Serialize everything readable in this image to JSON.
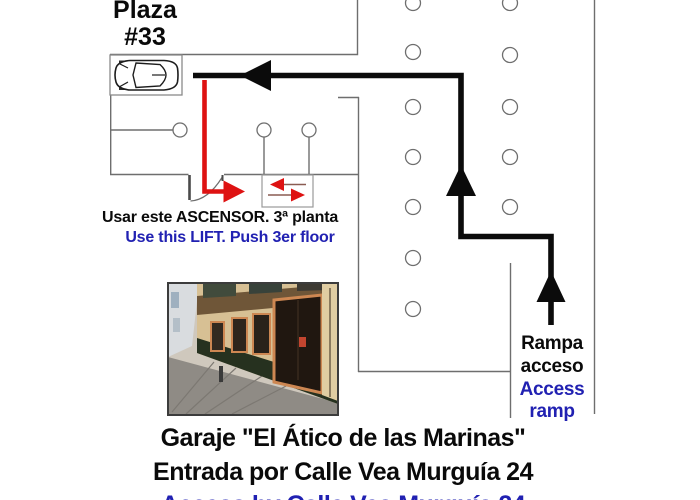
{
  "diagram": {
    "plaza_label": {
      "line1": "Plaza",
      "line2": "#33"
    },
    "lift_note_es": "Usar este ASCENSOR. 3ª planta",
    "lift_note_en": "Use this LIFT. Push 3er floor",
    "ramp_note": {
      "es_line1": "Rampa",
      "es_line2": "acceso",
      "en_line1": "Access",
      "en_line2": "ramp"
    }
  },
  "footer": {
    "title_es": "Garaje \"El Ático de las Marinas\"",
    "address_es": "Entrada por Calle Vea Murguía 24",
    "address_en": "Access by Calle Vea Murguía 24"
  },
  "icons": {
    "car": "car-top-view-icon",
    "route_arrows": [
      "left-arrow-icon",
      "up-arrow-icon",
      "up-arrow-icon"
    ],
    "walk_arrow": "red-right-arrow-icon",
    "elevator": "elevator-doors-icon",
    "door": "door-swing-icon",
    "photo": "garage-entrance-street-photo"
  },
  "colors": {
    "route_black": "#0b0b0b",
    "route_red": "#de1212",
    "text_blue": "#2121b2",
    "wall_gray": "#6e6e6e"
  }
}
